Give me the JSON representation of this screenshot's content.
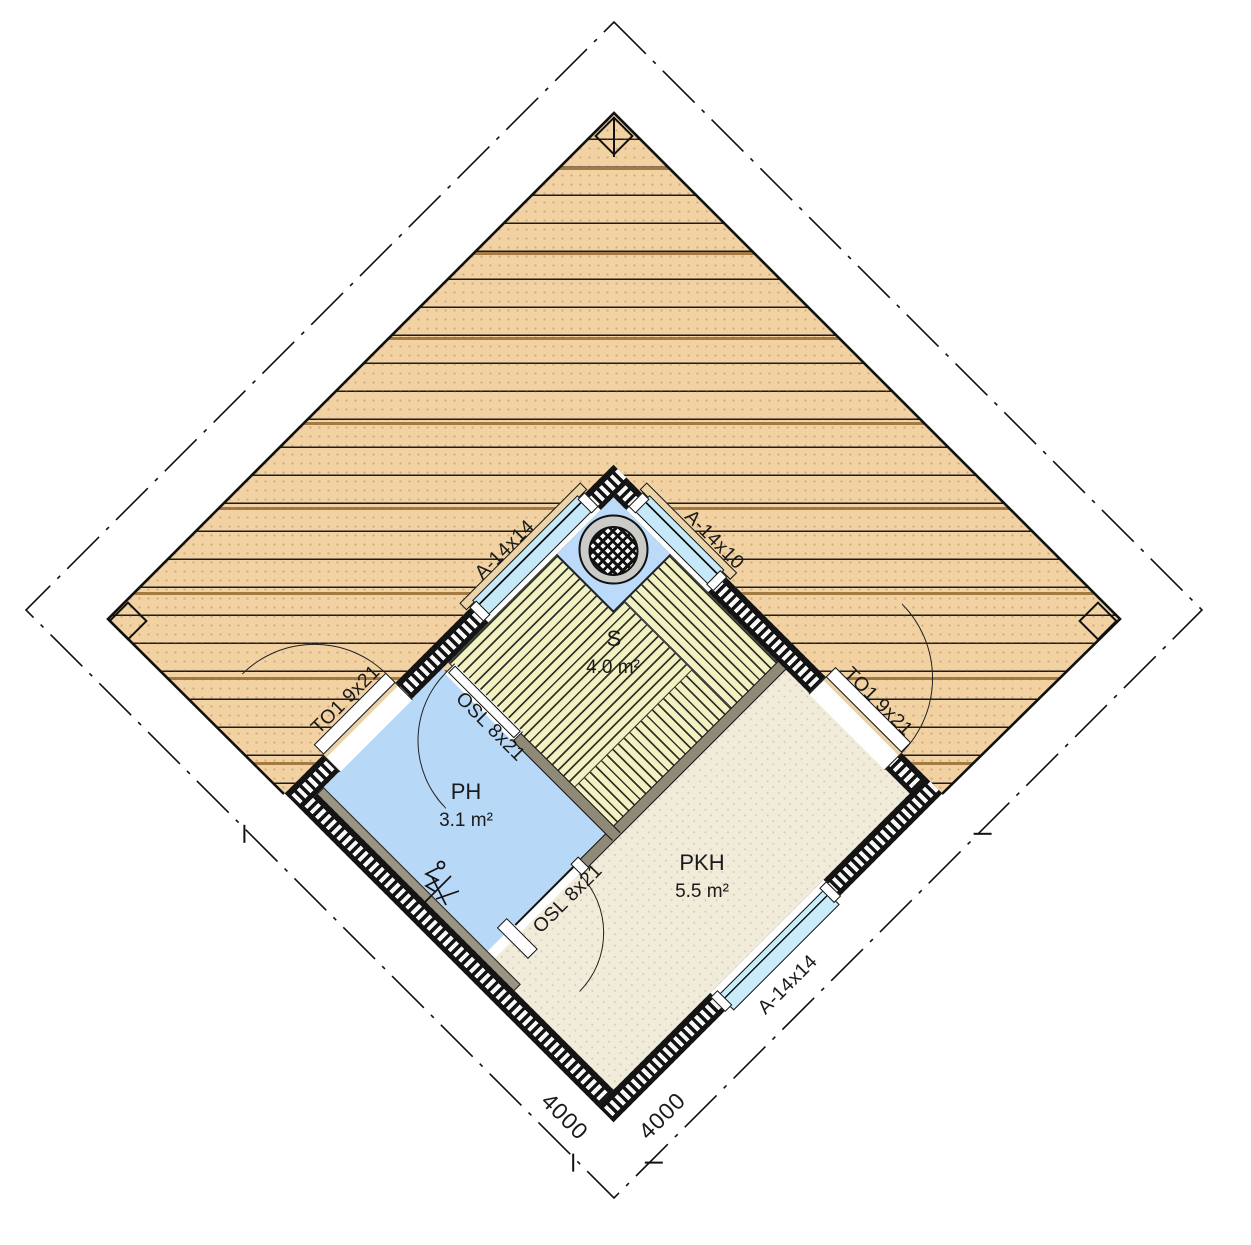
{
  "plan": {
    "rooms": [
      {
        "name": "S",
        "area": "4.0 m²"
      },
      {
        "name": "PH",
        "area": "3.1 m²"
      },
      {
        "name": "PKH",
        "area": "5.5 m²"
      }
    ],
    "windows": [
      {
        "label": "A-14x14",
        "wall": "northwest"
      },
      {
        "label": "A-14x10",
        "wall": "northeast"
      },
      {
        "label": "A-14x14",
        "wall": "southeast"
      }
    ],
    "doors": [
      {
        "label": "TO1 9x21",
        "wall": "northwest"
      },
      {
        "label": "TO1 9x21",
        "wall": "northeast"
      },
      {
        "label": "OSL 8x21",
        "location": "sauna-door"
      },
      {
        "label": "OSL 8x21",
        "location": "dressing-room-door"
      }
    ],
    "dimensions": [
      {
        "label": "4000",
        "side": "southwest"
      },
      {
        "label": "4000",
        "side": "southeast"
      }
    ],
    "colors": {
      "deck": "#f2d2a2",
      "wet_floor": "#b8d8f8",
      "dry_floor": "#f1ebd9",
      "bench": "#f1f1c2",
      "glazing": "#c8eafa",
      "wall": "#141414",
      "partition": "#8f8a77"
    }
  }
}
